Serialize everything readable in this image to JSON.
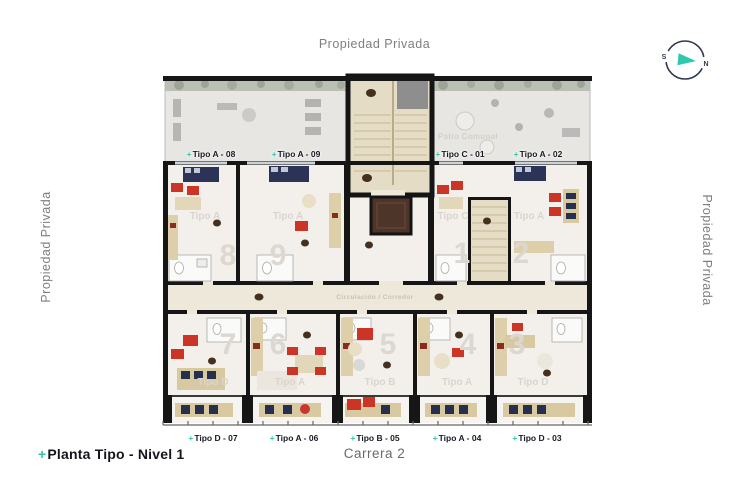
{
  "page": {
    "top_boundary_label": "Propiedad Privada",
    "left_boundary_label": "Propiedad Privada",
    "right_boundary_label": "Propiedad Privada",
    "street_label": "Carrera 2",
    "title": {
      "prefix": "+",
      "text": "Planta Tipo - Nivel 1"
    }
  },
  "compass": {
    "south": "S",
    "north": "N"
  },
  "plan": {
    "corridor_label": "Circulación / Corredor",
    "patio_label": "Patio Comunal",
    "unit_tags_top": [
      {
        "prefix": "+",
        "text": "Tipo A - 08"
      },
      {
        "prefix": "+",
        "text": "Tipo A - 09"
      },
      {
        "prefix": "+",
        "text": "Tipo C - 01"
      },
      {
        "prefix": "+",
        "text": "Tipo A - 02"
      }
    ],
    "unit_tags_bottom": [
      {
        "prefix": "+",
        "text": "Tipo D - 07"
      },
      {
        "prefix": "+",
        "text": "Tipo A - 06"
      },
      {
        "prefix": "+",
        "text": "Tipo B - 05"
      },
      {
        "prefix": "+",
        "text": "Tipo A - 04"
      },
      {
        "prefix": "+",
        "text": "Tipo D - 03"
      }
    ],
    "watermarks_top": [
      {
        "label": "Tipo A",
        "num": "8"
      },
      {
        "label": "Tipo A",
        "num": "9"
      },
      {
        "label": "Tipo C",
        "num": "1"
      },
      {
        "label": "Tipo A",
        "num": "2"
      }
    ],
    "watermarks_bottom": [
      {
        "label": "Tipo D",
        "num": "7"
      },
      {
        "label": "Tipo A",
        "num": "6"
      },
      {
        "label": "Tipo B",
        "num": "5"
      },
      {
        "label": "Tipo A",
        "num": "4"
      },
      {
        "label": "Tipo D",
        "num": "3"
      }
    ]
  },
  "colors": {
    "accent_teal": "#2ec4b0",
    "ink": "#15151e",
    "muted_gray": "#7e7e7e",
    "wall_black": "#161616",
    "furniture_red": "#cc3526",
    "furniture_navy": "#2b3357",
    "wood_beige": "#d9c9a1",
    "plan_floor": "#f3f0ec"
  }
}
